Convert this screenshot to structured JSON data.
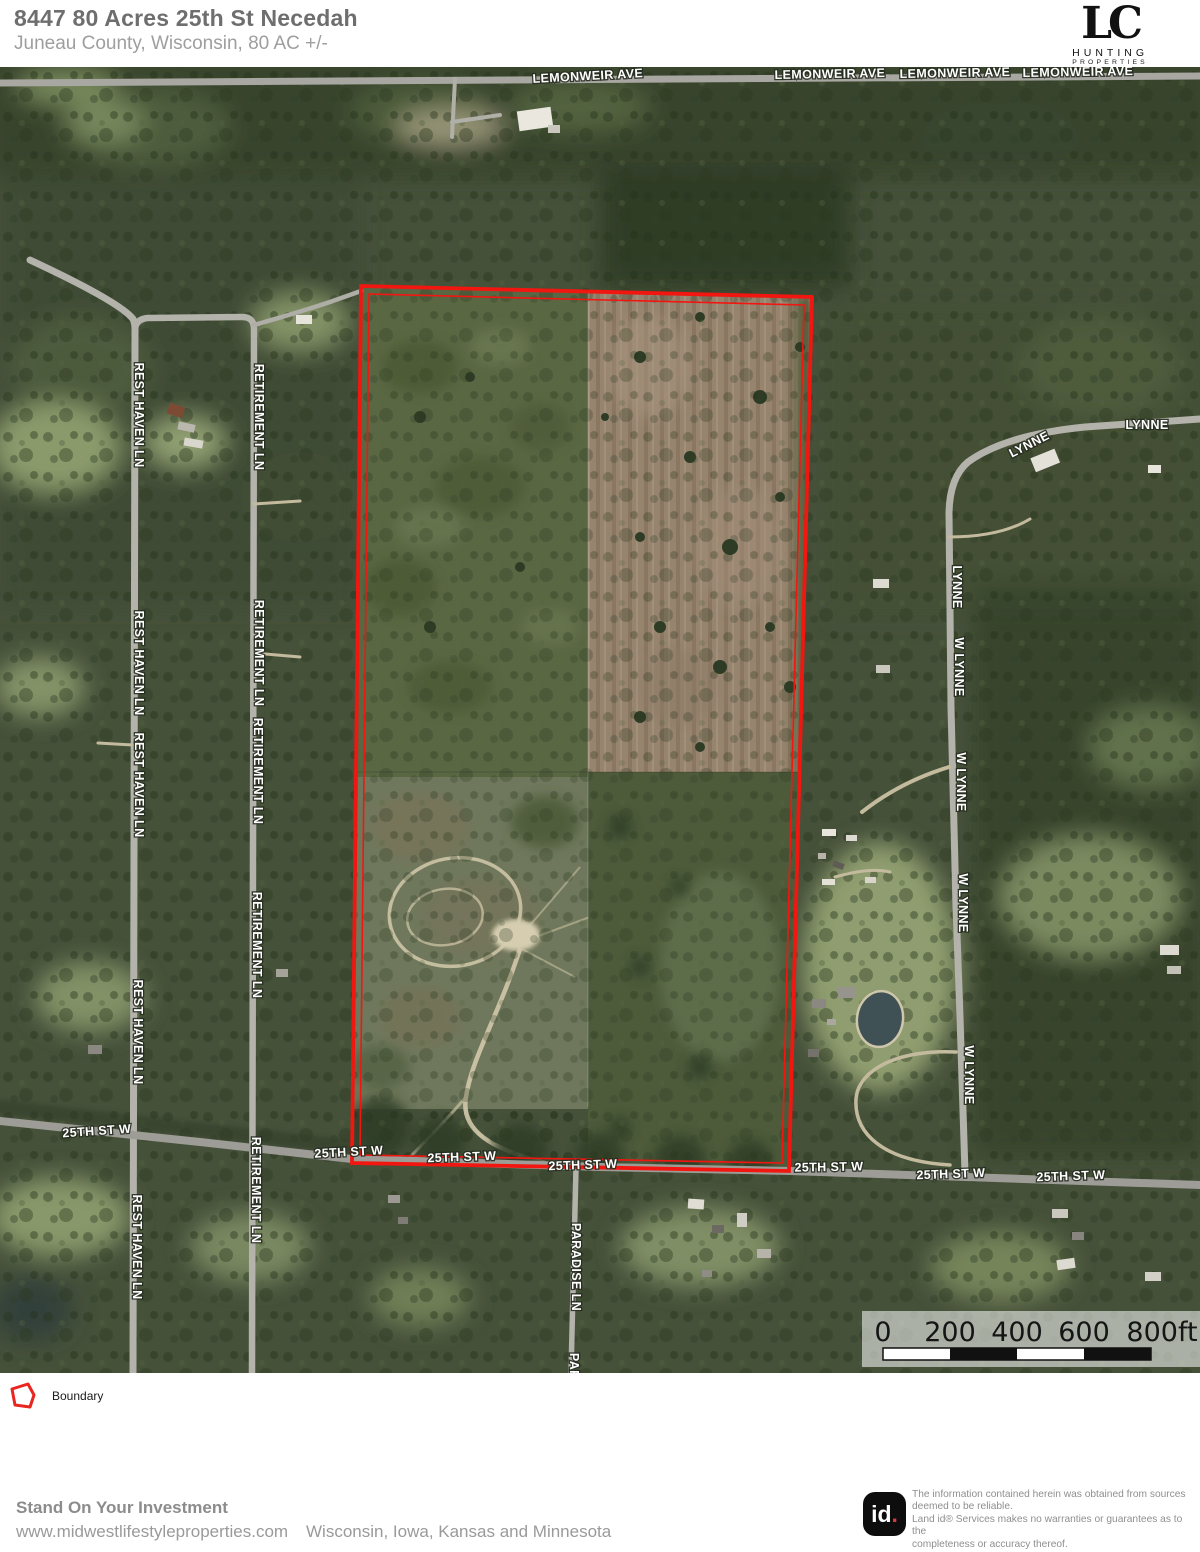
{
  "header": {
    "title": "8447 80 Acres 25th St Necedah",
    "subtitle": "Juneau County, Wisconsin, 80 AC +/-",
    "logo": {
      "mark": "LC",
      "line1": "HUNTING",
      "line2": "PROPERTIES"
    }
  },
  "map": {
    "boundary_color": "#f21611",
    "road_labels": [
      {
        "t": "LEMONWEIR AVE",
        "x": 588,
        "y": 13,
        "r": -3
      },
      {
        "t": "LEMONWEIR AVE",
        "x": 830,
        "y": 11,
        "r": -1
      },
      {
        "t": "LEMONWEIR AVE",
        "x": 955,
        "y": 10,
        "r": -1
      },
      {
        "t": "LEMONWEIR AVE",
        "x": 1078,
        "y": 9,
        "r": -1
      },
      {
        "t": "REST HAVEN LN",
        "x": 135,
        "y": 348,
        "r": 90
      },
      {
        "t": "REST HAVEN LN",
        "x": 135,
        "y": 596,
        "r": 90
      },
      {
        "t": "REST HAVEN LN",
        "x": 135,
        "y": 718,
        "r": 90
      },
      {
        "t": "REST HAVEN LN",
        "x": 134,
        "y": 965,
        "r": 90
      },
      {
        "t": "REST HAVEN LN",
        "x": 133,
        "y": 1180,
        "r": 90
      },
      {
        "t": "RETIREMENT LN",
        "x": 255,
        "y": 350,
        "r": 90
      },
      {
        "t": "RETIREMENT LN",
        "x": 255,
        "y": 586,
        "r": 90
      },
      {
        "t": "RETIREMENT LN",
        "x": 254,
        "y": 704,
        "r": 90
      },
      {
        "t": "RETIREMENT LN",
        "x": 253,
        "y": 878,
        "r": 90
      },
      {
        "t": "RETIREMENT LN",
        "x": 252,
        "y": 1123,
        "r": 90
      },
      {
        "t": "LYNNE",
        "x": 1147,
        "y": 362,
        "r": 0
      },
      {
        "t": "LYNNE",
        "x": 1031,
        "y": 381,
        "r": -27
      },
      {
        "t": "LYNNE",
        "x": 953,
        "y": 520,
        "r": 90
      },
      {
        "t": "W LYNNE",
        "x": 955,
        "y": 600,
        "r": 90
      },
      {
        "t": "W LYNNE",
        "x": 957,
        "y": 715,
        "r": 90
      },
      {
        "t": "W LYNNE",
        "x": 959,
        "y": 836,
        "r": 90
      },
      {
        "t": "W LYNNE",
        "x": 965,
        "y": 1008,
        "r": 90
      },
      {
        "t": "PARADISE LN",
        "x": 572,
        "y": 1200,
        "r": 90
      },
      {
        "t": "PARADISE LN",
        "x": 570,
        "y": 1330,
        "r": 90
      },
      {
        "t": "25TH ST W",
        "x": 97,
        "y": 1068,
        "r": -4
      },
      {
        "t": "25TH ST W",
        "x": 349,
        "y": 1089,
        "r": -3
      },
      {
        "t": "25TH ST W",
        "x": 462,
        "y": 1094,
        "r": -2
      },
      {
        "t": "25TH ST W",
        "x": 583,
        "y": 1102,
        "r": -2
      },
      {
        "t": "25TH ST W",
        "x": 829,
        "y": 1104,
        "r": -1
      },
      {
        "t": "25TH ST W",
        "x": 951,
        "y": 1111,
        "r": -2
      },
      {
        "t": "25TH ST W",
        "x": 1071,
        "y": 1113,
        "r": -2
      }
    ],
    "scale_bar": {
      "labels": [
        "0",
        "200",
        "400",
        "600",
        "800ft"
      ]
    }
  },
  "legend": {
    "boundary_label": "Boundary"
  },
  "footer": {
    "tagline": "Stand On Your Investment",
    "website": "www.midwestlifestyleproperties.com",
    "regions": "Wisconsin, Iowa, Kansas and Minnesota",
    "id_logo": "id",
    "disclaimer_lines": [
      "The information contained herein was obtained from sources",
      "deemed to be reliable.",
      " Land id® Services makes no warranties or guarantees as to the",
      "completeness or accuracy thereof."
    ]
  }
}
